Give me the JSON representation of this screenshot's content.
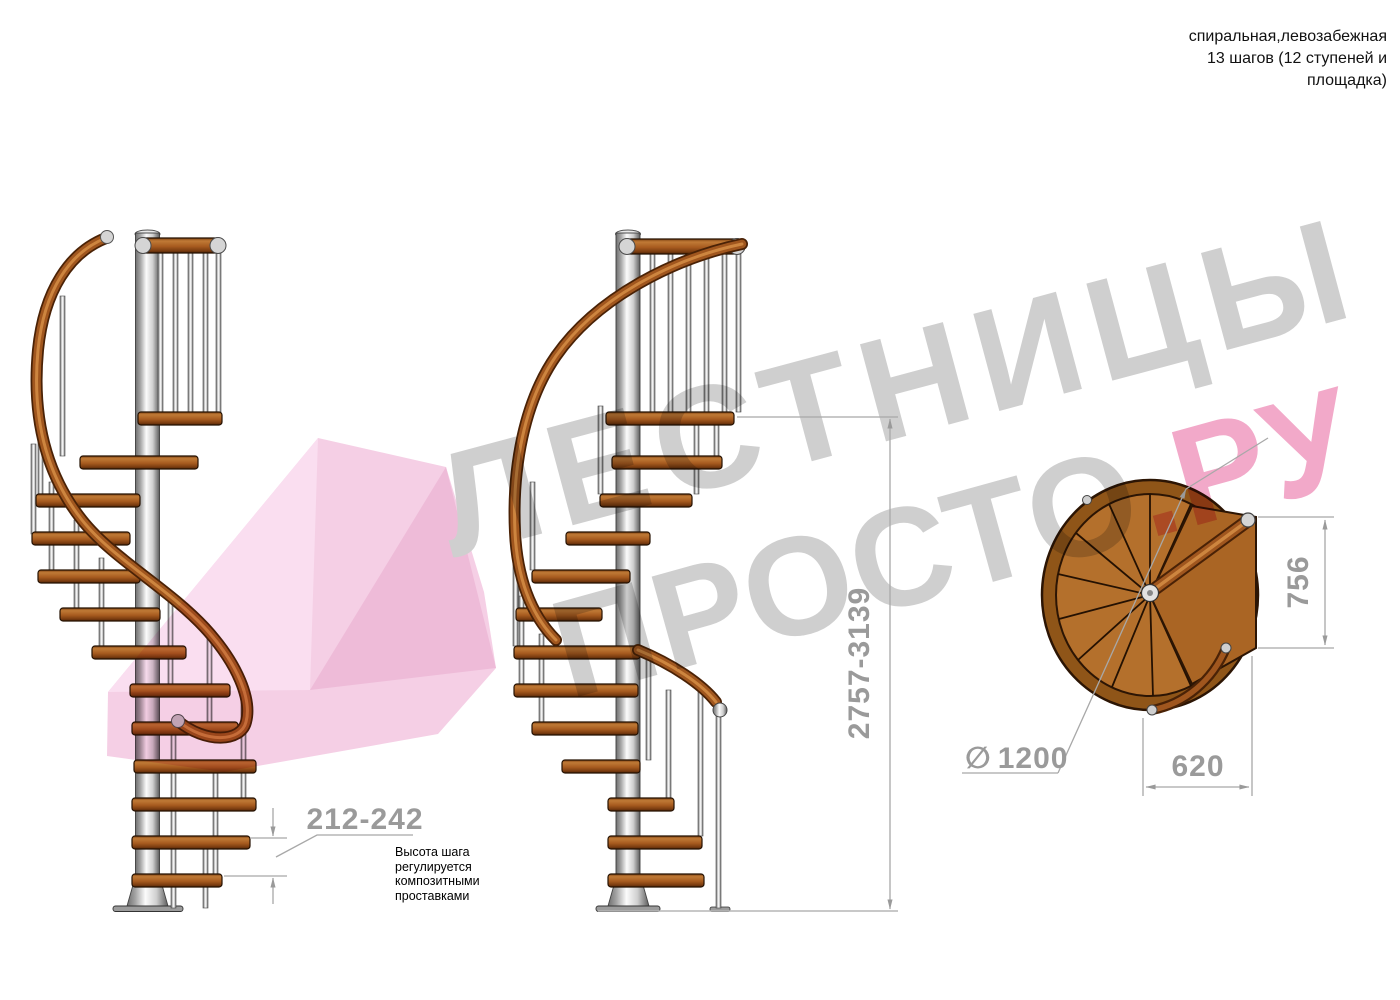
{
  "header": {
    "line1": "спиральная,левозабежная",
    "line2": "13 шагов (12 ступеней и",
    "line3": "площадка)"
  },
  "watermark": {
    "line1": "ЛЕСТНИЦЫ",
    "line2_gray": "ПРОСТО",
    "line2_pink": ".РУ",
    "gray_color": "#cfcfcf",
    "pink_color": "#f2a9c9"
  },
  "dimensions": {
    "step_height": {
      "value": "212-242",
      "note_lines": [
        "Высота шага",
        "регулируется",
        "композитными",
        "проставками"
      ]
    },
    "total_height": {
      "value": "2757-3139"
    },
    "platform_width": {
      "value": "756"
    },
    "step_width": {
      "value": "620"
    },
    "diameter": {
      "symbol": "∅",
      "value": "1200"
    }
  },
  "colors": {
    "wood": "#a85c20",
    "wood_dark": "#4a2206",
    "metal": "#d9d9d9",
    "dimension_gray": "#9a9a9a",
    "accent_pink": "#f2a9c9"
  }
}
